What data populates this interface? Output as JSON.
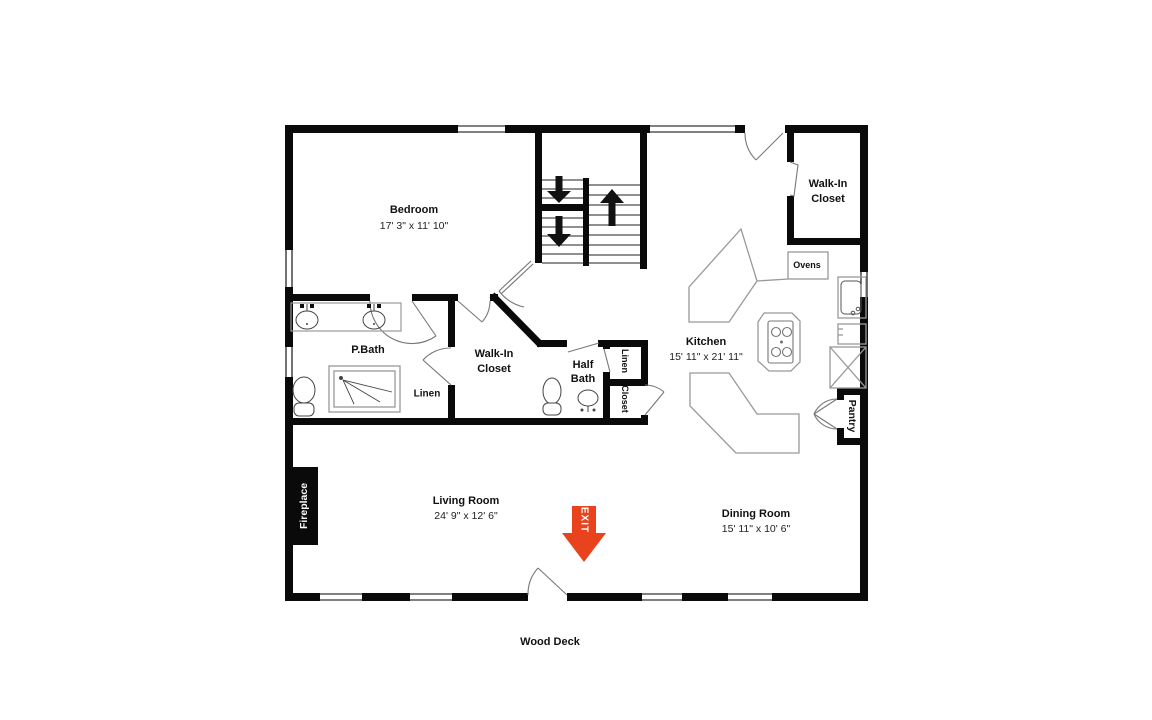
{
  "floorplan": {
    "labels": {
      "bedroom_name": "Bedroom",
      "bedroom_dims": "17' 3\" x 11' 10\"",
      "walk_in_closet_top_1": "Walk-In",
      "walk_in_closet_top_2": "Closet",
      "kitchen_name": "Kitchen",
      "kitchen_dims": "15' 11\" x 21' 11\"",
      "p_bath": "P.Bath",
      "linen_bath": "Linen",
      "walk_in_closet_mid_1": "Walk-In",
      "walk_in_closet_mid_2": "Closet",
      "half_bath_1": "Half",
      "half_bath_2": "Bath",
      "linen_hall": "Linen",
      "closet_hall": "Closet",
      "pantry": "Pantry",
      "ovens": "Ovens",
      "fireplace": "Fireplace",
      "living_name": "Living Room",
      "living_dims": "24' 9\" x 12' 6\"",
      "dining_name": "Dining Room",
      "dining_dims": "15' 11\" x 10' 6\"",
      "wood_deck": "Wood Deck",
      "exit": "EXIT"
    },
    "colors": {
      "exit_arrow": "#E8431C",
      "wall": "#000000"
    }
  }
}
